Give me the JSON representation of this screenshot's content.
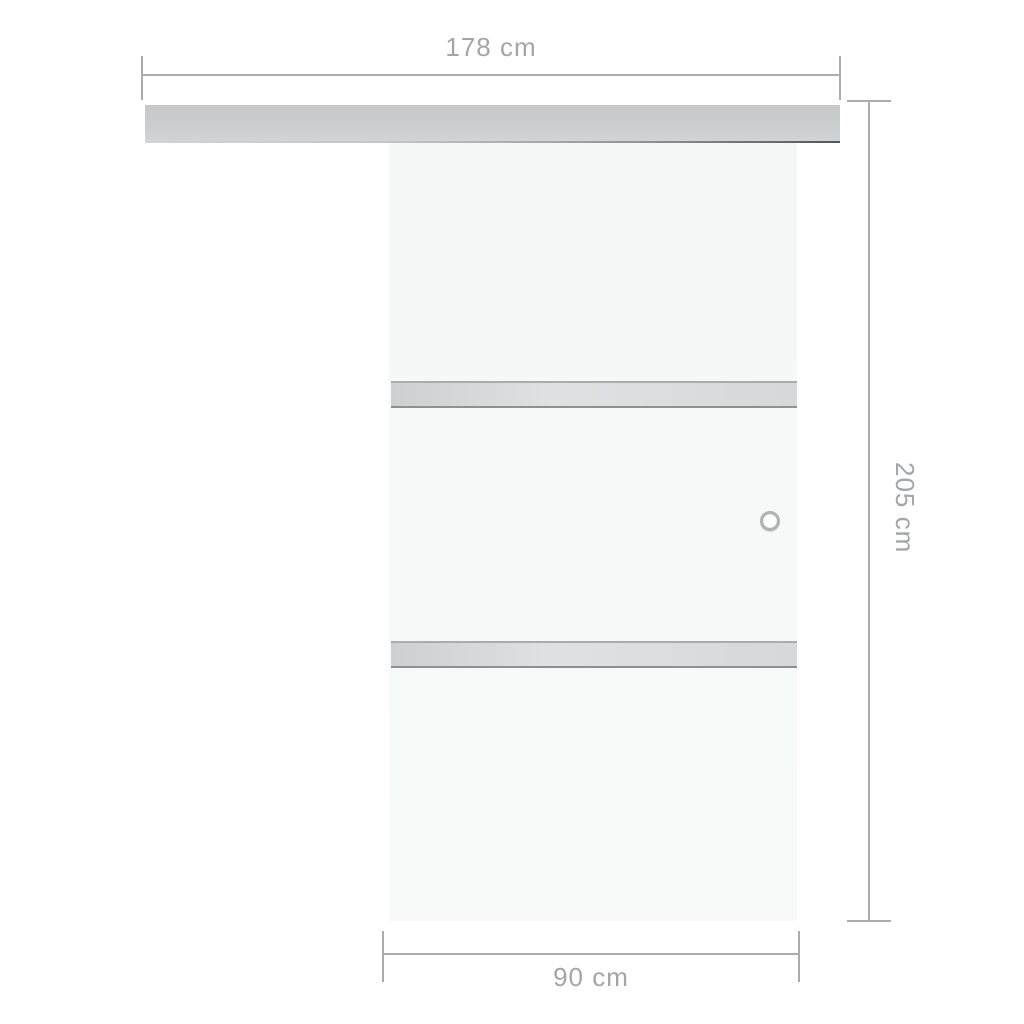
{
  "diagram": {
    "type": "product-dimension-diagram",
    "subject": "sliding-glass-door-with-track-rail"
  },
  "dimensions": {
    "track_width": {
      "label": "178 cm",
      "position": "top"
    },
    "door_height": {
      "label": "205 cm",
      "position": "right"
    },
    "door_width": {
      "label": "90 cm",
      "position": "bottom"
    }
  },
  "colors": {
    "background": "#ffffff",
    "dim-line": "#aaacae",
    "dim-text": "#a3a5a7",
    "rail-gray": "#c9cbcc",
    "panel": "#f5f8f7",
    "stripe-body": "#d6d8d9",
    "stripe-edge": "#8e9092",
    "handle-ring": "#b0b2b4"
  }
}
